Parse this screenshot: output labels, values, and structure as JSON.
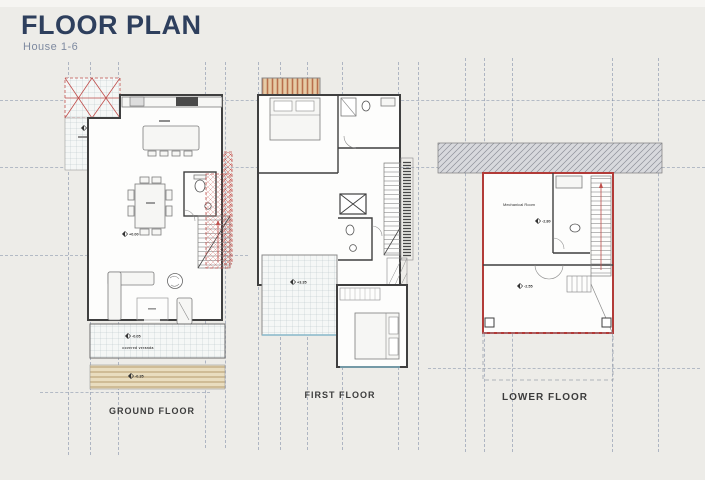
{
  "header": {
    "title": "FLOOR PLAN",
    "subtitle": "House 1-6"
  },
  "plans": {
    "ground": {
      "label": "GROUND FLOOR",
      "levels": {
        "carport": "-0.05",
        "main": "+0.00",
        "veranda": "-0.05",
        "deck": "-0.35"
      },
      "veranda_caption": "covered veranda"
    },
    "first": {
      "label": "FIRST FLOOR",
      "levels": {
        "terrace": "+3.35"
      }
    },
    "lower": {
      "label": "LOWER FLOOR",
      "room_label": "Mechanical Room",
      "levels": {
        "mechanical_room": "-2.80",
        "courtyard": "-2.55"
      }
    }
  },
  "colors": {
    "title_navy": "#2e3f5d",
    "accent_red": "#c0504d",
    "wall_dark": "#3f3f3f",
    "glass_blue": "#86b7c9",
    "grid_line": "#7a88a2",
    "background": "#edece8"
  }
}
